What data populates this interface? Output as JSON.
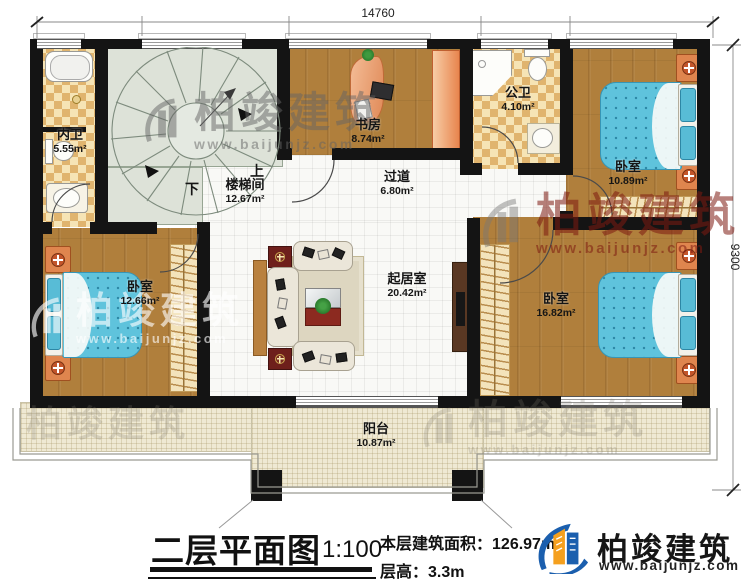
{
  "plan": {
    "title": "二层平面图",
    "scale": "1:100",
    "area_label": "本层建筑面积：",
    "area_value": "126.97m²",
    "floor_height_label": "层高：",
    "floor_height_value": "3.3m",
    "dim_width": "14760",
    "dim_height": "9300"
  },
  "rooms": {
    "neiwei": {
      "name": "内卫",
      "area": "5.55m²"
    },
    "loutijian": {
      "name": "楼梯间",
      "area": "12.67m²"
    },
    "shufang": {
      "name": "书房",
      "area": "8.74m²"
    },
    "gongwei": {
      "name": "公卫",
      "area": "4.10m²"
    },
    "bedroom_tr": {
      "name": "卧室",
      "area": "10.89m²"
    },
    "guodao": {
      "name": "过道",
      "area": "6.80m²"
    },
    "qijushi": {
      "name": "起居室",
      "area": "20.42m²"
    },
    "bedroom_bl": {
      "name": "卧室",
      "area": "12.66m²"
    },
    "bedroom_br": {
      "name": "卧室",
      "area": "16.82m²"
    },
    "yangtai": {
      "name": "阳台",
      "area": "10.87m²"
    }
  },
  "stairs": {
    "up": "上",
    "down": "下"
  },
  "brand": {
    "name": "柏竣建筑",
    "site": "www.baijunjz.com"
  },
  "watermark": {
    "name": "柏竣建筑",
    "site": "www.baijunjz.com"
  },
  "colors": {
    "wall": "#141414",
    "wood": "#b07f3c",
    "bed_blue": "#5fc3dc",
    "checker": "#e0b46e",
    "logo_blue": "#1b5fae",
    "logo_orange": "#f5a01e",
    "watermark_red": "#7d1910"
  }
}
